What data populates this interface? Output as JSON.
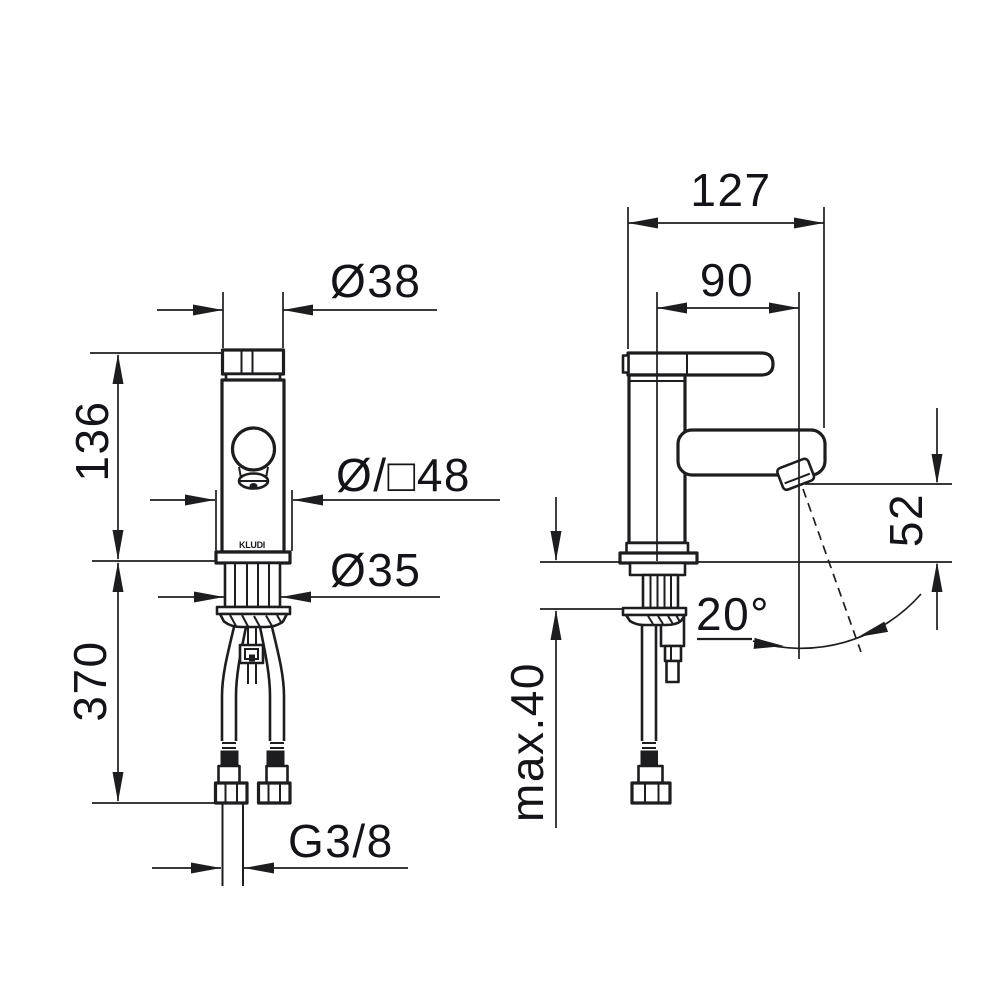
{
  "document": {
    "type": "technical dimension drawing",
    "subject": "single-lever basin mixer tap, front and side view",
    "background_color": "#ffffff",
    "line_color": "#1d1d20",
    "text_color": "#141418"
  },
  "brand": {
    "logo": "KLUDI"
  },
  "front_view": {
    "dim_cap_diameter": "Ø38",
    "dim_upper_height": "136",
    "dim_body_round_or_square": "Ø/□48",
    "dim_shank_diameter": "Ø35",
    "dim_hose_length": "370",
    "dim_connection_thread": "G3/8"
  },
  "side_view": {
    "dim_overall_depth": "127",
    "dim_spout_reach": "90",
    "dim_outlet_height": "52",
    "dim_outlet_angle": "20°",
    "dim_max_deck_thickness": "max.40"
  }
}
